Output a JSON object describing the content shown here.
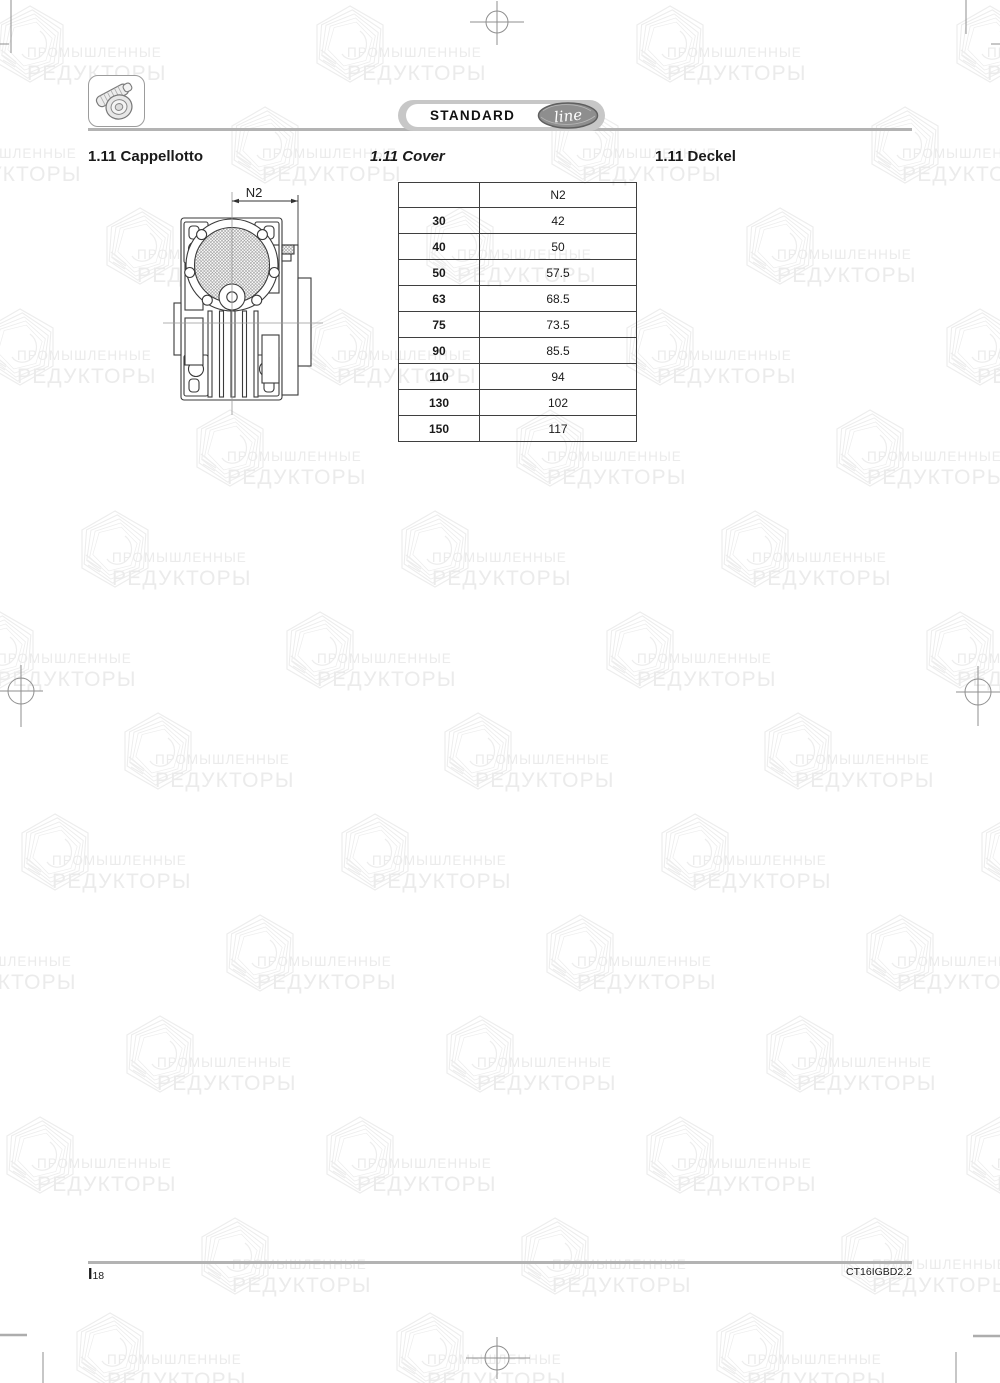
{
  "watermark": {
    "line1": "ПРОМЫШЛЕННЫЕ",
    "line2": "РЕДУКТОРЫ"
  },
  "header": {
    "badge_label": "STANDARD",
    "badge_script": "line"
  },
  "titles": {
    "it": "1.11 Cappellotto",
    "en": "1.11 Cover",
    "de": "1.11 Deckel"
  },
  "drawing": {
    "dimension_label": "N2"
  },
  "table": {
    "header": "N2",
    "rows": [
      {
        "size": "30",
        "value": "42"
      },
      {
        "size": "40",
        "value": "50"
      },
      {
        "size": "50",
        "value": "57.5"
      },
      {
        "size": "63",
        "value": "68.5"
      },
      {
        "size": "75",
        "value": "73.5"
      },
      {
        "size": "90",
        "value": "85.5"
      },
      {
        "size": "110",
        "value": "94"
      },
      {
        "size": "130",
        "value": "102"
      },
      {
        "size": "150",
        "value": "117"
      }
    ]
  },
  "footer": {
    "page_letter": "I",
    "page_number": "18",
    "doc_code": "CT16IGBD2.2"
  },
  "colors": {
    "rule_gray": "#b3b3b3",
    "badge_gray": "#c7c7c7",
    "badge_ellipse": "#8e8e8e",
    "watermark_gray": "#ebebeb",
    "line_dark": "#3a3a3a"
  }
}
